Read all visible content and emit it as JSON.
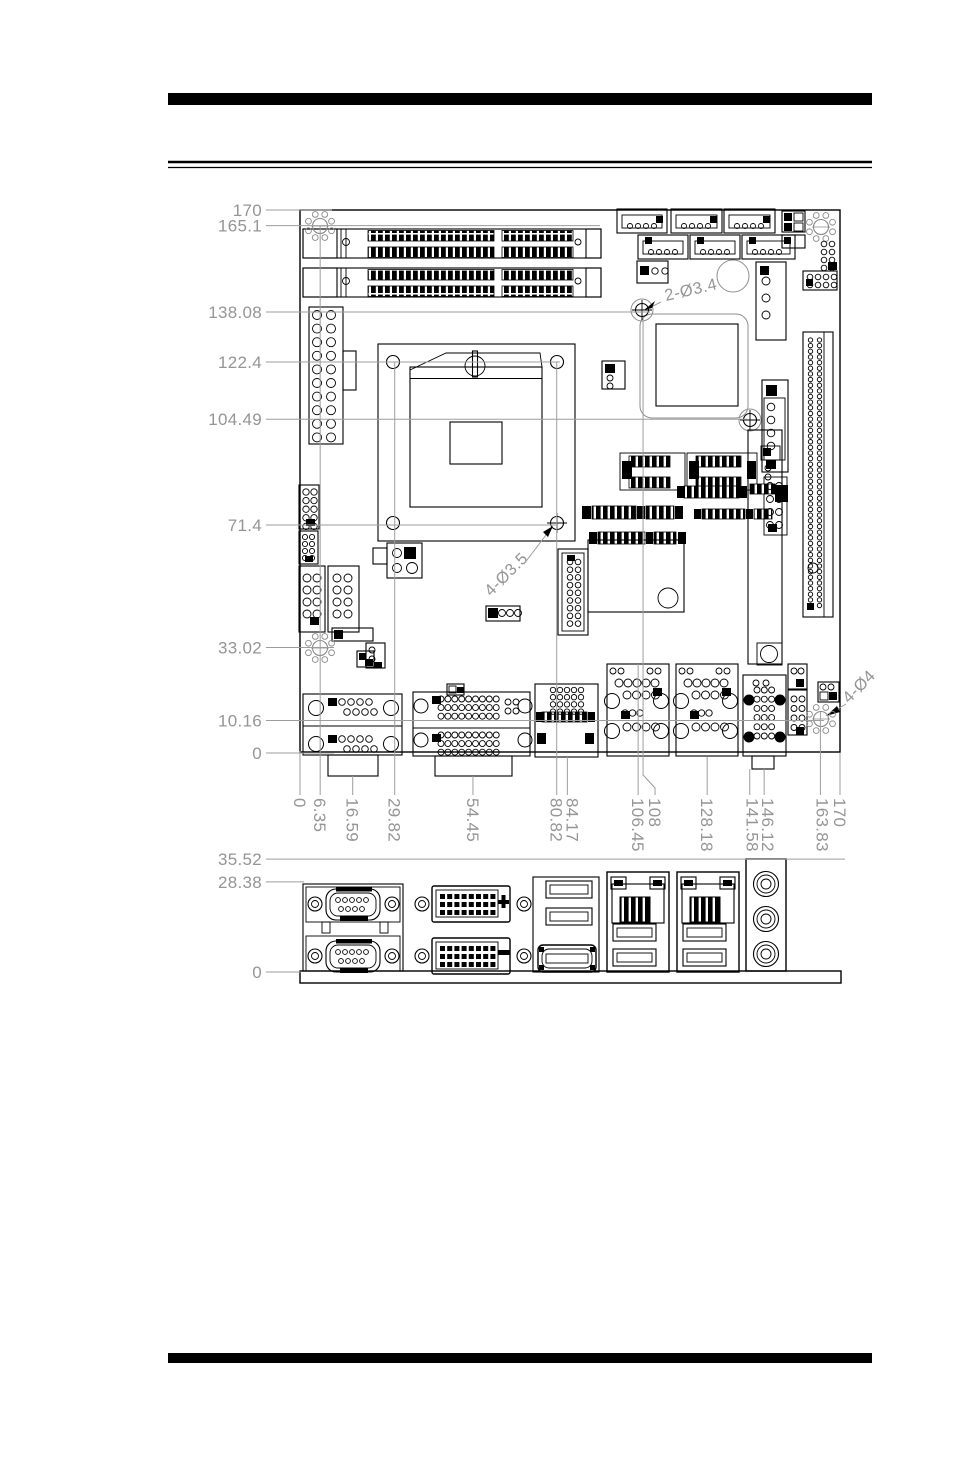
{
  "main_view": {
    "dims_left": [
      {
        "label": "170",
        "mm": 170
      },
      {
        "label": "165.1",
        "mm": 165.1
      },
      {
        "label": "138.08",
        "mm": 138.08
      },
      {
        "label": "122.4",
        "mm": 122.4
      },
      {
        "label": "104.49",
        "mm": 104.49
      },
      {
        "label": "71.4",
        "mm": 71.4
      },
      {
        "label": "33.02",
        "mm": 33.02
      },
      {
        "label": "10.16",
        "mm": 10.16
      },
      {
        "label": "0",
        "mm": 0
      }
    ],
    "dims_bottom": [
      {
        "label": "0",
        "mm": 0
      },
      {
        "label": "6.35",
        "mm": 6.35
      },
      {
        "label": "16.59",
        "mm": 16.59
      },
      {
        "label": "29.82",
        "mm": 29.82
      },
      {
        "label": "54.45",
        "mm": 54.45
      },
      {
        "label": "80.82",
        "mm": 80.82
      },
      {
        "label": "84.17",
        "mm": 84.17
      },
      {
        "label": "106.45",
        "mm": 106.45
      },
      {
        "label": "108",
        "mm": 108
      },
      {
        "label": "128.18",
        "mm": 128.18
      },
      {
        "label": "141.58",
        "mm": 141.58
      },
      {
        "label": "146.12",
        "mm": 146.12
      },
      {
        "label": "163.83",
        "mm": 163.83
      },
      {
        "label": "170",
        "mm": 170
      }
    ],
    "annotations": [
      {
        "text": "2-Ø3.4"
      },
      {
        "text": "4-Ø3.5"
      },
      {
        "text": "4-Ø4"
      }
    ]
  },
  "io_view": {
    "dims_left": [
      {
        "label": "35.52",
        "mm": 35.52
      },
      {
        "label": "28.38",
        "mm": 28.38
      },
      {
        "label": "0",
        "mm": 0
      }
    ]
  }
}
